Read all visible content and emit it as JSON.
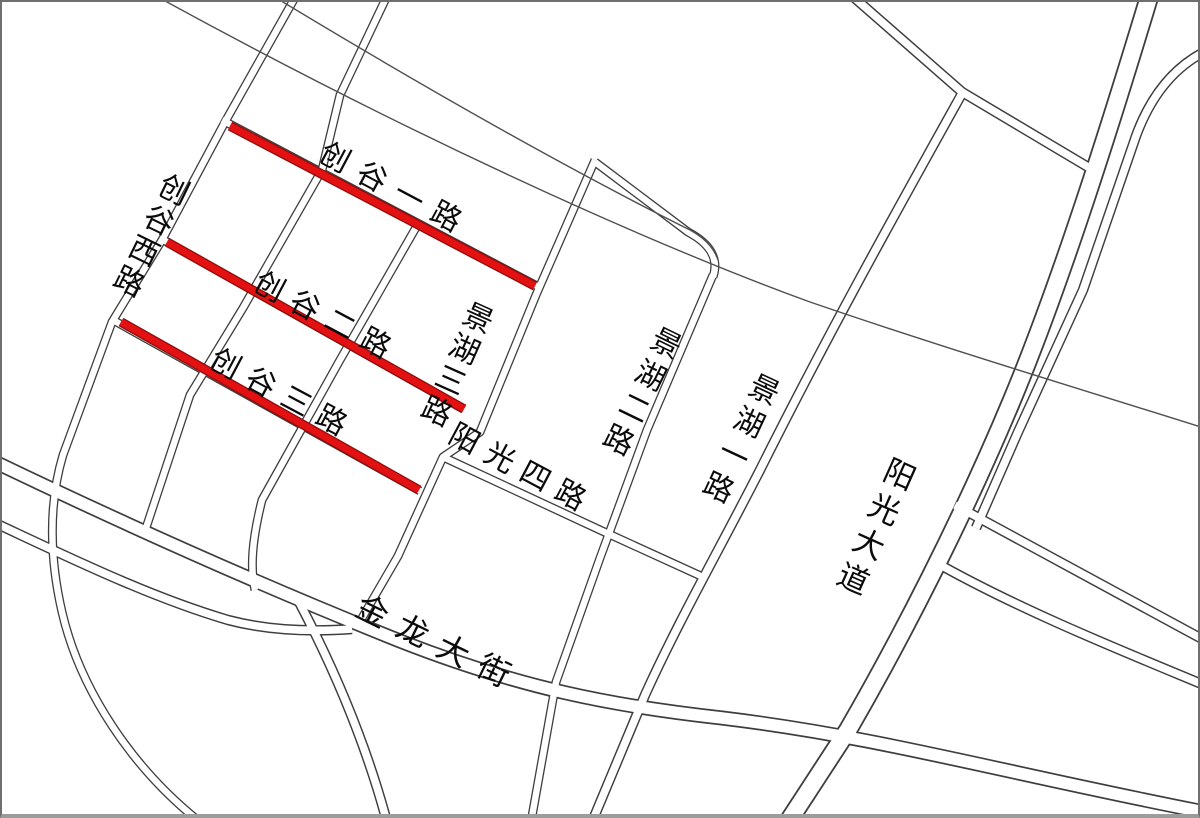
{
  "map": {
    "type": "street-map",
    "background_color": "#ffffff",
    "road_outline_color": "#3e3e3e",
    "road_fill_color": "#ffffff",
    "border_color": "#6f6f6f",
    "label_color": "#0b0b0b",
    "highlight": {
      "core_color": "#e31111",
      "edge_color": "#8f0e0e",
      "core_width": 7,
      "edge_width": 9.6
    },
    "streets": [
      {
        "id": "chuanggu-yi-lu",
        "name": "创谷一路",
        "highlighted": true
      },
      {
        "id": "chuanggu-er-lu",
        "name": "创谷二路",
        "highlighted": true
      },
      {
        "id": "chuanggu-san-lu",
        "name": "创谷三路",
        "highlighted": true
      },
      {
        "id": "chuanggu-xi-lu",
        "name": "创谷西路",
        "highlighted": false
      },
      {
        "id": "jinghu-san-lu",
        "name": "景湖三路",
        "highlighted": false
      },
      {
        "id": "jinghu-er-lu",
        "name": "景湖二路",
        "highlighted": false
      },
      {
        "id": "jinghu-yi-lu",
        "name": "景湖一路",
        "highlighted": false
      },
      {
        "id": "yangguang-si-lu",
        "name": "阳光四路",
        "highlighted": false
      },
      {
        "id": "yangguang-dadao",
        "name": "阳光大道",
        "highlighted": false
      },
      {
        "id": "jinlong-dajie",
        "name": "金龙大街",
        "highlighted": false
      }
    ],
    "labels": [
      {
        "id": "chuanggu-yi-lu",
        "text": "创谷一路",
        "x": 390,
        "y": 188,
        "rot": 28,
        "dir": "h",
        "size": 30,
        "gap": 12
      },
      {
        "id": "chuanggu-xi-lu",
        "text": "创谷西路",
        "x": 151,
        "y": 237,
        "rot": 26,
        "dir": "v",
        "size": 30,
        "gap": 4
      },
      {
        "id": "chuanggu-er-lu",
        "text": "创谷二路",
        "x": 322,
        "y": 316,
        "rot": 28,
        "dir": "h",
        "size": 30,
        "gap": 10
      },
      {
        "id": "chuanggu-san-lu",
        "text": "创谷三路",
        "x": 278,
        "y": 393,
        "rot": 28,
        "dir": "h",
        "size": 30,
        "gap": 10
      },
      {
        "id": "jinghu-san-lu",
        "text": "景湖三路",
        "x": 457,
        "y": 366,
        "rot": 24,
        "dir": "v",
        "size": 30,
        "gap": 4
      },
      {
        "id": "yangguang-si-lu",
        "text": "阳光四路",
        "x": 517,
        "y": 468,
        "rot": 28,
        "dir": "h",
        "size": 30,
        "gap": 10
      },
      {
        "id": "jinghu-er-lu",
        "text": "景湖二路",
        "x": 642,
        "y": 393,
        "rot": 26,
        "dir": "v",
        "size": 30,
        "gap": 6
      },
      {
        "id": "jinghu-yi-lu",
        "text": "景湖一路",
        "x": 741,
        "y": 440,
        "rot": 25,
        "dir": "v",
        "size": 30,
        "gap": 6
      },
      {
        "id": "yangguang-dadao",
        "text": "阳光大道",
        "x": 876,
        "y": 528,
        "rot": 24,
        "dir": "v",
        "size": 31,
        "gap": 7
      },
      {
        "id": "jinlong-dajie",
        "text": "金龙大街",
        "x": 433,
        "y": 641,
        "rot": 26,
        "dir": "h",
        "size": 32,
        "gap": 13
      }
    ],
    "highlighted_segments": [
      {
        "id": "chuanggu-yi-lu",
        "x1": 230,
        "y1": 126,
        "x2": 535,
        "y2": 286
      },
      {
        "id": "chuanggu-er-lu",
        "x1": 167,
        "y1": 242,
        "x2": 464,
        "y2": 409
      },
      {
        "id": "chuanggu-san-lu",
        "x1": 121,
        "y1": 322,
        "x2": 419,
        "y2": 490
      }
    ]
  }
}
